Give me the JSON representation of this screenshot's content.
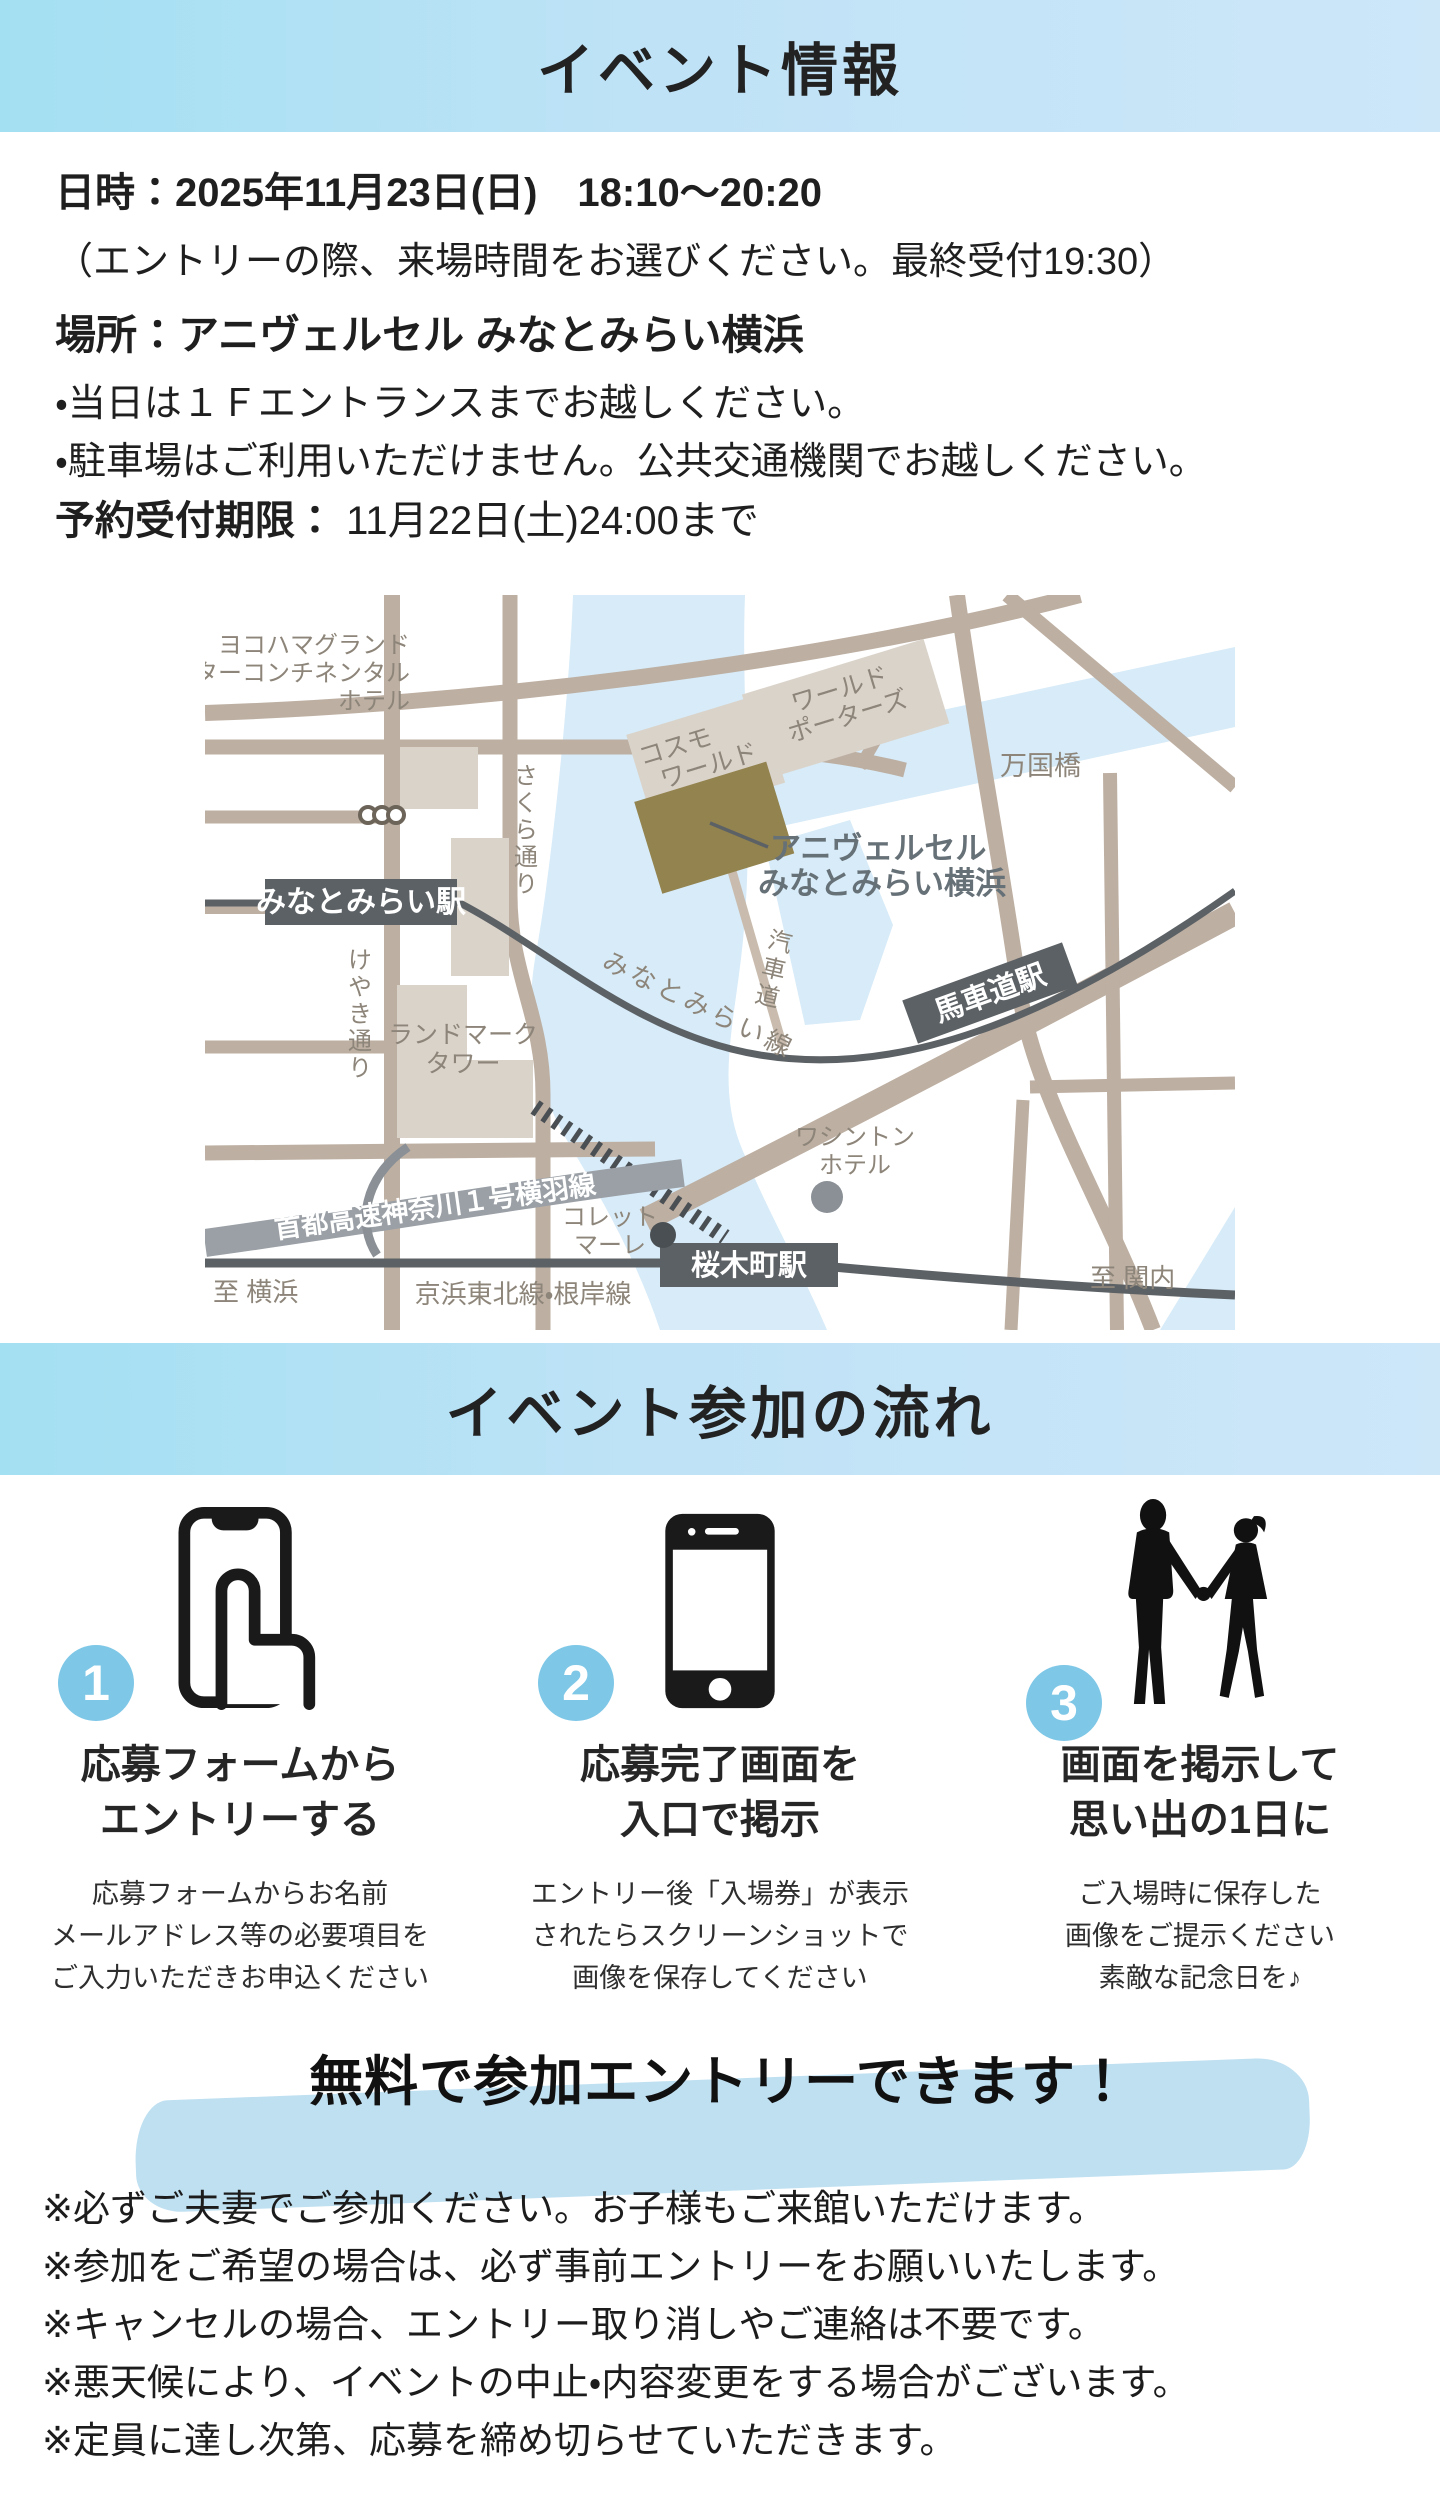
{
  "header1": {
    "title": "イベント情報"
  },
  "event_info": {
    "datetime_label": "日時：",
    "datetime_value": "2025年11月23日(日)　18:10〜20:20",
    "entry_note": "（エントリーの際、来場時間をお選びください。最終受付19:30）",
    "place_label": "場所：",
    "place_value": "アニヴェルセル みなとみらい横浜",
    "bullets": [
      "・当日は１Ｆエントランスまでお越しください。",
      "・駐車場はご利用いただけません。公共交通機関でお越しください。"
    ],
    "deadline_label": "予約受付期限：",
    "deadline_value": " 11月22日(土)24:00まで"
  },
  "map": {
    "hotel_intercontinental": [
      "ヨコハマグランド",
      "インターコンチネンタル",
      "ホテル"
    ],
    "cosmo_world": [
      "コスモ",
      "ワールド"
    ],
    "world_porters": [
      "ワールド",
      "ポーターズ"
    ],
    "bankokubashi": "万国橋",
    "venue": [
      "アニヴェルセル",
      "みなとみらい横浜"
    ],
    "sakura_street": "さくら通り",
    "keyaki_street": "けやき通り",
    "kishamichi": "汽車道",
    "minatomirai_station": "みなとみらい駅",
    "minatomirai_line": "みなとみらい線",
    "bashamichi_station": "馬車道駅",
    "landmark_tower": [
      "ランドマーク",
      "タワー"
    ],
    "shuto_expressway": "首都高速神奈川１号横羽線",
    "washington_hotel": [
      "ワシントン",
      "ホテル"
    ],
    "colette_mare": [
      "コレット",
      "マーレ"
    ],
    "sakuragicho_station": "桜木町駅",
    "to_yokohama": "至 横浜",
    "keihin_tohoku_line": "京浜東北線・根岸線",
    "to_kannai": "至 関内"
  },
  "header2": {
    "title": "イベント参加の流れ"
  },
  "steps": [
    {
      "number": "1",
      "icon": "phone-tap-icon",
      "title_lines": [
        "応募フォームから",
        "エントリーする"
      ],
      "desc_lines": [
        "応募フォームからお名前",
        "メールアドレス等の必要項目を",
        "ご入力いただきお申込ください"
      ]
    },
    {
      "number": "2",
      "icon": "smartphone-icon",
      "title_lines": [
        "応募完了画面を",
        "入口で掲示"
      ],
      "desc_lines": [
        "エントリー後「入場券」が表示",
        "されたらスクリーンショットで",
        "画像を保存してください"
      ]
    },
    {
      "number": "3",
      "icon": "couple-icon",
      "title_lines": [
        "画面を掲示して",
        "思い出の1日に"
      ],
      "desc_lines": [
        "ご入場時に保存した",
        "画像をご提示ください",
        "素敵な記念日を♪"
      ]
    }
  ],
  "banner": {
    "text": "無料で参加エントリーできます！"
  },
  "notes": [
    "※必ずご夫妻でご参加ください。お子様もご来館いただけます。",
    "※参加をご希望の場合は、必ず事前エントリーをお願いいたします。",
    "※キャンセルの場合、エントリー取り消しやご連絡は不要です。",
    "※悪天候により、イベントの中止・内容変更をする場合がございます。",
    "※定員に達し次第、応募を締め切らせていただきます。"
  ],
  "colors": {
    "header_gradient_left": "#a3e0f2",
    "header_gradient_right": "#cde7f9",
    "step_badge_blue": "#7ec7e7",
    "highlight_blue": "#bfe0f1",
    "map_road": "#bdafa2",
    "map_water": "#d7ebf8",
    "map_building": "#dad3ca",
    "map_venue_building": "#93834f",
    "map_rail_dark": "#5c6165",
    "map_label_gray": "#8d8579",
    "map_highway_gray": "#9aa0a6"
  }
}
